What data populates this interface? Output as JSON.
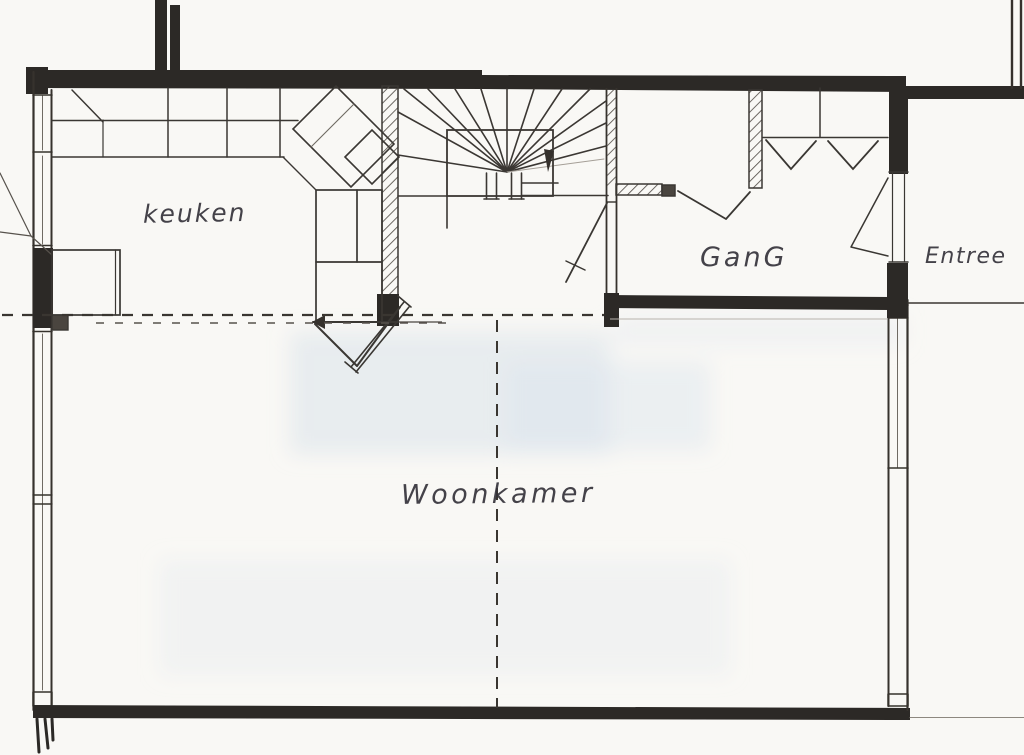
{
  "floorplan": {
    "rooms": [
      {
        "id": "keuken",
        "label": "keuken"
      },
      {
        "id": "gang",
        "label": "GanG"
      },
      {
        "id": "entree",
        "label": "Entree"
      },
      {
        "id": "woonkamer",
        "label": "Woonkamer"
      }
    ],
    "features": {
      "staircase": "spiral-stair",
      "closet": "closet",
      "wardrobe": "coat-rack",
      "kitchen_counter": "counter"
    },
    "colors": {
      "ink": "#2e2b28",
      "paper": "#f7f6f2",
      "shading": "#d9e2eb"
    }
  }
}
